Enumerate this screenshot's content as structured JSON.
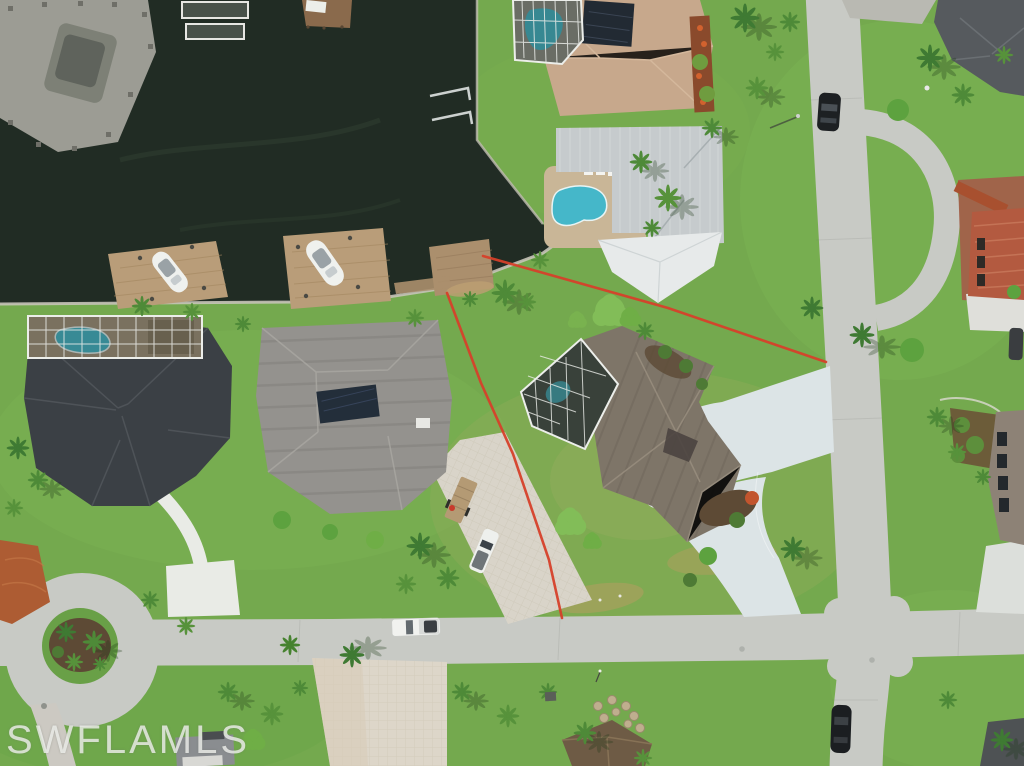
{
  "meta": {
    "type": "aerial-photograph",
    "width_px": 1024,
    "height_px": 766,
    "description": "Overhead drone photo of a Florida waterfront neighborhood: dark canal with docks and two boats on lifts at top left, single-family homes with pools and screened lanais, curving concrete and paver driveways, a palm-ringed cul-de-sac at lower left, a street intersection at right, and red surveyor boundary lines marking a center waterfront lot."
  },
  "watermark": {
    "text": "SWFLAMLS",
    "color": "rgba(242,244,240,0.78)"
  },
  "scene": {
    "counts": {
      "boats_on_lifts": 2,
      "docks": 6,
      "pools": 4,
      "houses": 9,
      "vehicles": 6,
      "boundary_lines": 2,
      "streets": 2,
      "cul_de_sacs": 1
    },
    "colors": {
      "water": "#212c24",
      "grass": "#74a94e",
      "grass_dark": "#69a047",
      "street": "#c8cac5",
      "driveway_concrete": "#dce4e6",
      "paver_light": "#ddd6c9",
      "dock_wood": "#b99d79",
      "boundary_red": "#d6402a",
      "pool": "#45b7c9",
      "pool_shaded": "#377a80",
      "roof_tan": "#c7a88c",
      "roof_metal": "#c6cbcd",
      "roof_white_wing": "#e7eaea",
      "roof_taupe": "#7e7568",
      "roof_charcoal": "#3b4045",
      "roof_gray": "#94928e",
      "roof_dark_gray": "#565a5e",
      "roof_terracotta": "#b35a40",
      "roof_brown": "#6e5b45",
      "screen_dark": "#39413a",
      "cage_frame": "#eceeea",
      "mulch": "#5d4a35",
      "boat_white": "#eff1ee",
      "car_black": "#1d2023",
      "truck_white": "#f1f2ef",
      "clay_paver": "#ad5c33"
    }
  }
}
